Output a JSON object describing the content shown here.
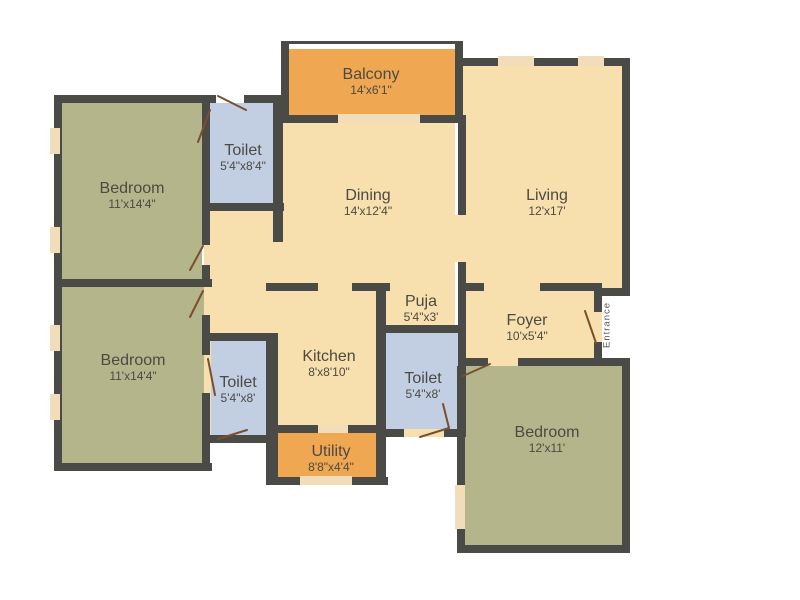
{
  "title": "2BHK-style apartment floor plan",
  "rooms": [
    {
      "id": "bedroom-top-left",
      "name": "Bedroom",
      "dims": "11'x14'4\""
    },
    {
      "id": "toilet-top",
      "name": "Toilet",
      "dims": "5'4\"x8'4\""
    },
    {
      "id": "balcony",
      "name": "Balcony",
      "dims": "14'x6'1\""
    },
    {
      "id": "dining",
      "name": "Dining",
      "dims": "14'x12'4\""
    },
    {
      "id": "living",
      "name": "Living",
      "dims": "12'x17'"
    },
    {
      "id": "bedroom-mid-left",
      "name": "Bedroom",
      "dims": "11'x14'4\""
    },
    {
      "id": "toilet-bottom-left",
      "name": "Toilet",
      "dims": "5'4\"x8'"
    },
    {
      "id": "kitchen",
      "name": "Kitchen",
      "dims": "8'x8'10\""
    },
    {
      "id": "puja",
      "name": "Puja",
      "dims": "5'4\"x3'"
    },
    {
      "id": "toilet-bottom-mid",
      "name": "Toilet",
      "dims": "5'4\"x8'"
    },
    {
      "id": "foyer",
      "name": "Foyer",
      "dims": "10'x5'4\""
    },
    {
      "id": "utility",
      "name": "Utility",
      "dims": "8'8\"x4'4\""
    },
    {
      "id": "bedroom-bottom-right",
      "name": "Bedroom",
      "dims": "12'x11'"
    }
  ],
  "entrance_label": "Entrance",
  "colors": {
    "wall": "#4a4a47",
    "floor": "#f7e0ad",
    "bedroom": "#b4b58a",
    "toilet": "#c2cfe3",
    "accent": "#f0a751",
    "window": "#f2ddbb",
    "door": "#7b4e2e",
    "text": "#4c4a43",
    "background": "#ffffff"
  }
}
